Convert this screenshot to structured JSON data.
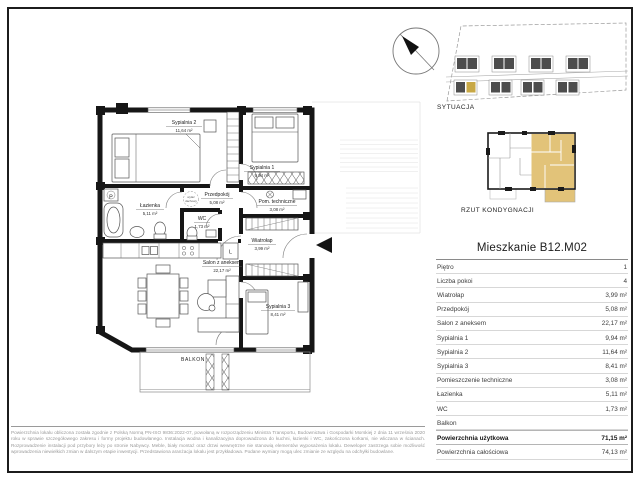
{
  "colors": {
    "highlight_gold": "#C8A845",
    "keyplan_gold": "#E2C379",
    "wall_black": "#161616"
  },
  "site_plan": {
    "label": "SYTUACJA"
  },
  "key_plan": {
    "label": "RZUT KONDYGNACJI"
  },
  "floor_plan": {
    "balcony_label": "BALKON",
    "markers": {
      "washer": "P",
      "fridge": "L",
      "roof_hatch_l1": "wyłaz",
      "roof_hatch_l2": "dachowy"
    },
    "rooms": {
      "sypialnia2": {
        "name": "Sypialnia 2",
        "area": "11,64 m²"
      },
      "sypialnia1": {
        "name": "Sypialnia 1",
        "area": "9,94 m²"
      },
      "lazienka": {
        "name": "Łazienka",
        "area": "5,11 m²"
      },
      "wc": {
        "name": "WC",
        "area": "1,73 m²"
      },
      "przedpokoj": {
        "name": "Przedpokój",
        "area": "5,08 m²"
      },
      "pom_techniczne": {
        "name": "Pom. techniczne",
        "area": "3,08 m²"
      },
      "wiatrolap": {
        "name": "Wiatrołap",
        "area": "3,99 m²"
      },
      "salon": {
        "name": "Salon z aneksem",
        "area": "22,17 m²"
      },
      "sypialnia3": {
        "name": "Sypialnia 3",
        "area": "8,41 m²"
      }
    }
  },
  "table": {
    "title": "Mieszkanie B12.M02",
    "rows": [
      {
        "label": "Piętro",
        "value": "1"
      },
      {
        "label": "Liczba pokoi",
        "value": "4"
      },
      {
        "label": "Wiatrołap",
        "value": "3,99 m²"
      },
      {
        "label": "Przedpokój",
        "value": "5,08 m²"
      },
      {
        "label": "Salon z aneksem",
        "value": "22,17 m²"
      },
      {
        "label": "Sypialnia 1",
        "value": "9,94 m²"
      },
      {
        "label": "Sypialnia 2",
        "value": "11,64 m²"
      },
      {
        "label": "Sypialnia 3",
        "value": "8,41 m²"
      },
      {
        "label": "Pomieszczenie techniczne",
        "value": "3,08 m²"
      },
      {
        "label": "Łazienka",
        "value": "5,11 m²"
      },
      {
        "label": "WC",
        "value": "1,73 m²"
      },
      {
        "label": "Balkon",
        "value": ""
      },
      {
        "label": "Powierzchnia użytkowa",
        "value": "71,15 m²",
        "bold": true
      },
      {
        "label": "Powierzchnia całościowa",
        "value": "74,13 m²"
      }
    ]
  },
  "disclaimer": "Powierzchnia lokalu obliczona została zgodnie z Polską Normą PN-ISO 9836:2022-07, powołaną w rozporządzeniu Ministra Transportu, Budownictwa i Gospodarki Morskiej z dnia 11 września 2020 roku w sprawie szczegółowego zakresu i formy projektu budowlanego. Instalacja wodna i kanalizacyjna doprowadzona do kuchni, łazienki i WC, zakończona korkami, nie wliczana w ścianach. Rozprowadzenie instalacji pod przybory leży po stronie Nabywcy. Meble, biały montaż oraz drzwi wewnętrzne nie stanowią elementów wyposażenia lokalu. Deweloper zastrzega sobie możliwość wprowadzenia niewielkich zmian w dalszym etapie inwestycji. Przedstawiona aranżacja lokalu jest przykładowa. Podane wymiary mogą ulec zmianie ze względu na odchyłki budowlane."
}
